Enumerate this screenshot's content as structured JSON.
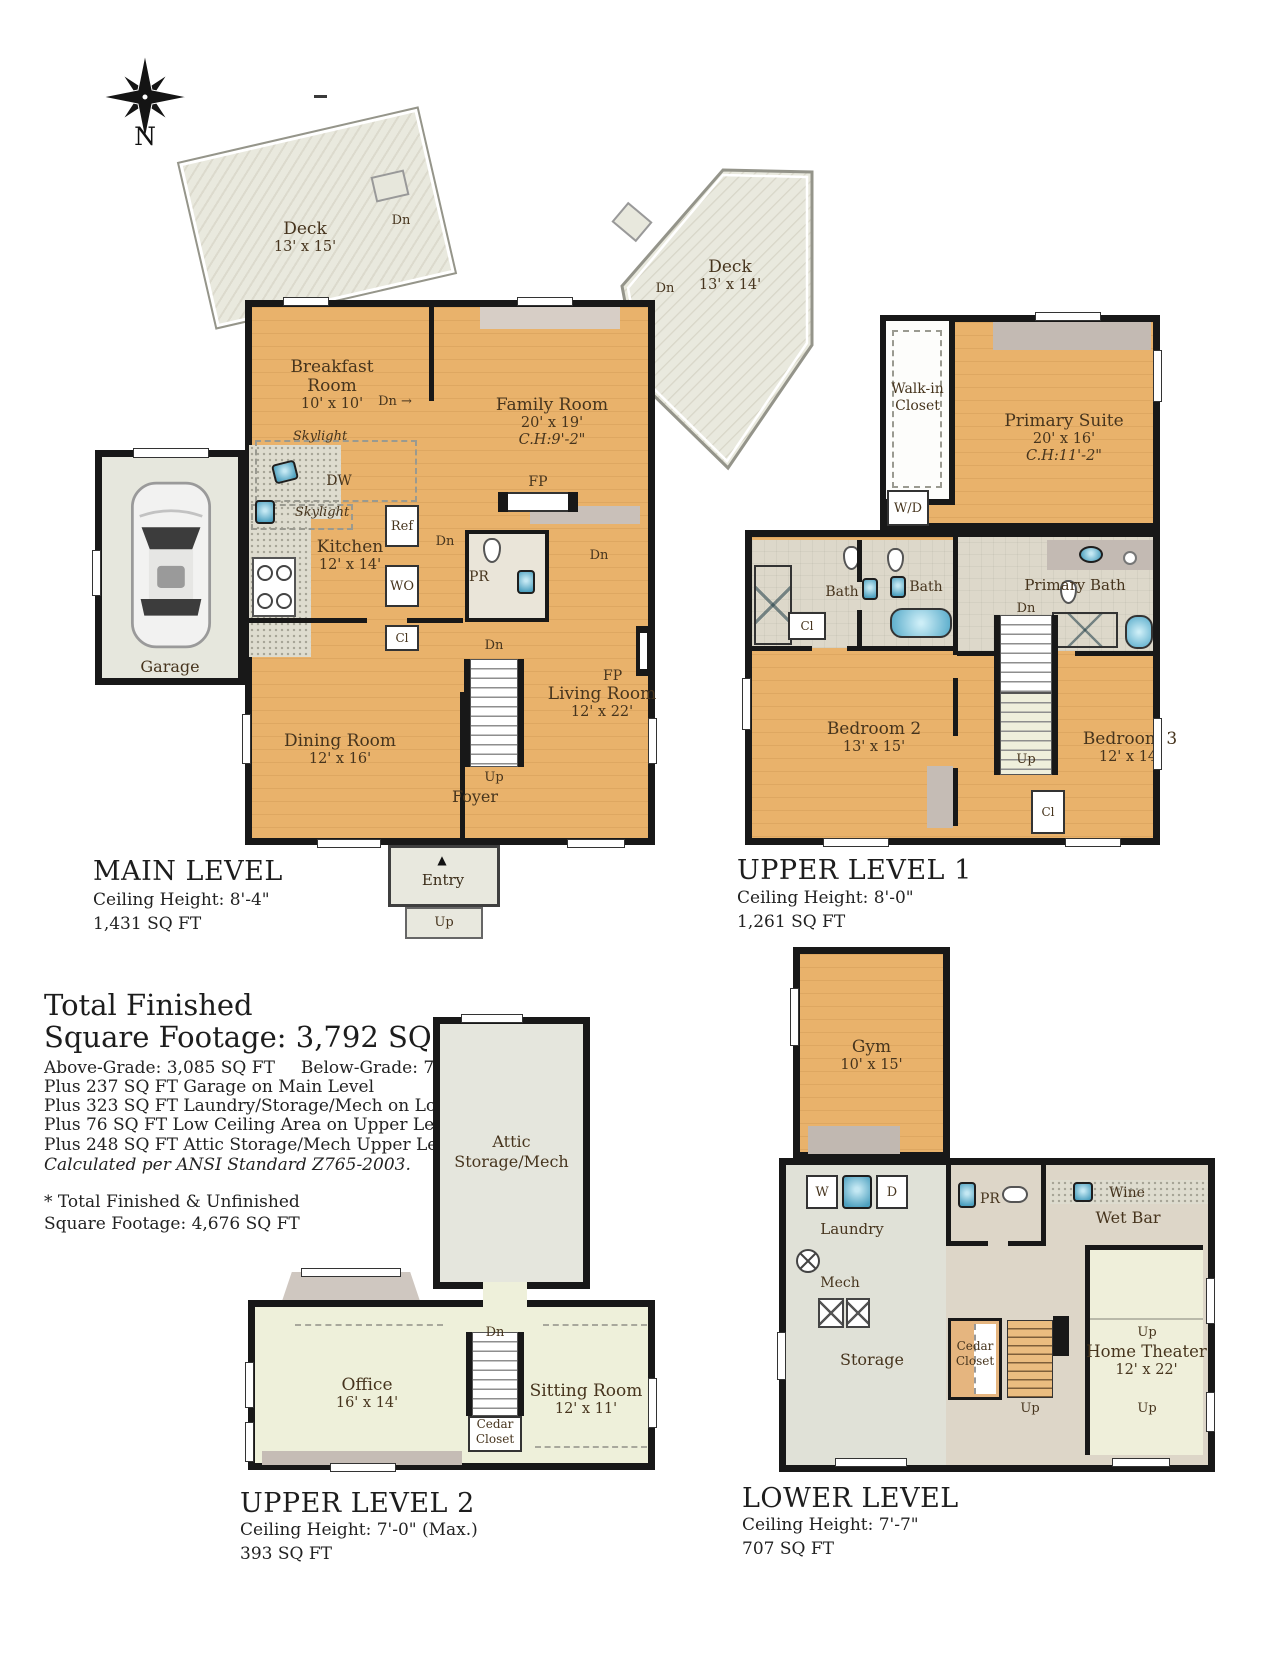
{
  "colors": {
    "wood_floor": "#e9b26b",
    "deck": "#e7e7dc",
    "tile": "#ddd8ca",
    "pale_floor": "#eef0da",
    "gray_room": "#e4e5db",
    "wall": "#181818",
    "fixture_blue": "#5fb3d1",
    "label_brown": "#46341d",
    "furniture_gray": "#c5bcb5"
  },
  "icons": {
    "compass_rose": "8-point star",
    "entry_triangle": "▲",
    "right_arrow": "→"
  },
  "compass": {
    "north": "N"
  },
  "main_level": {
    "title": "MAIN LEVEL",
    "ceiling": "Ceiling Height: 8'-4\"",
    "area": "1,431 SQ FT",
    "deck_left": {
      "name": "Deck",
      "dims": "13' x 15'"
    },
    "deck_right": {
      "name": "Deck",
      "dims": "13' x 14'"
    },
    "rooms": {
      "breakfast": {
        "line1": "Breakfast",
        "line2": "Room",
        "dims": "10' x 10'"
      },
      "family": {
        "name": "Family Room",
        "dims": "20' x 19'",
        "ch": "C.H:9'-2\""
      },
      "kitchen": {
        "name": "Kitchen",
        "dims": "12' x 14'"
      },
      "dining": {
        "name": "Dining Room",
        "dims": "12' x 16'"
      },
      "living": {
        "name": "Living Room",
        "dims": "12' x 22'"
      },
      "garage": "Garage",
      "foyer": "Foyer",
      "entry": "Entry"
    },
    "tags": {
      "skylight": "Skylight",
      "dw": "DW",
      "ref": "Ref",
      "wo": "WO",
      "cl": "Cl",
      "pr": "PR",
      "fp": "FP",
      "dn": "Dn",
      "up": "Up"
    }
  },
  "upper_level_1": {
    "title": "UPPER LEVEL 1",
    "ceiling": "Ceiling Height: 8'-0\"",
    "area": "1,261 SQ FT",
    "rooms": {
      "walkin": {
        "line1": "Walk-in",
        "line2": "Closet"
      },
      "primary": {
        "name": "Primary Suite",
        "dims": "20' x 16'",
        "ch": "C.H:11'-2\""
      },
      "bath": "Bath",
      "primary_bath": "Primary Bath",
      "bedroom2": {
        "name": "Bedroom 2",
        "dims": "13' x 15'"
      },
      "bedroom3": {
        "name": "Bedroom 3",
        "dims": "12' x 14'"
      }
    },
    "tags": {
      "wd": "W/D",
      "cl": "Cl",
      "dn": "Dn",
      "up": "Up"
    }
  },
  "summary": {
    "line1": "Total Finished",
    "line2": "Square Footage: 3,792 SQ FT",
    "above": "Above-Grade: 3,085 SQ FT",
    "below": "Below-Grade: 707 SQ FT",
    "plus": [
      "Plus 237 SQ FT Garage on Main Level",
      "Plus 323 SQ FT Laundry/Storage/Mech on Lower Level",
      "Plus 76 SQ FT Low Ceiling Area on Upper Level 2",
      "Plus 248 SQ FT Attic Storage/Mech Upper Level 2"
    ],
    "ansi": "Calculated per ANSI Standard Z765-2003.",
    "unfinished1": "* Total Finished & Unfinished",
    "unfinished2": "Square Footage: 4,676 SQ FT"
  },
  "upper_level_2": {
    "title": "UPPER LEVEL 2",
    "ceiling": "Ceiling Height: 7'-0\" (Max.)",
    "area": "393 SQ FT",
    "rooms": {
      "attic": {
        "line1": "Attic",
        "line2": "Storage/Mech"
      },
      "office": {
        "name": "Office",
        "dims": "16' x 14'"
      },
      "sitting": {
        "name": "Sitting Room",
        "dims": "12' x 11'"
      },
      "cedar": {
        "line1": "Cedar",
        "line2": "Closet"
      }
    },
    "tags": {
      "dn": "Dn"
    }
  },
  "lower_level": {
    "title": "LOWER LEVEL",
    "ceiling": "Ceiling Height: 7'-7\"",
    "area": "707 SQ FT",
    "rooms": {
      "gym": {
        "name": "Gym",
        "dims": "10' x 15'"
      },
      "laundry": "Laundry",
      "storage": "Storage",
      "mech": "Mech",
      "wine": "Wine",
      "wetbar": "Wet Bar",
      "home_theater": {
        "name": "Home Theater",
        "dims": "12' x 22'"
      },
      "cedar": {
        "line1": "Cedar",
        "line2": "Closet"
      }
    },
    "tags": {
      "w": "W",
      "d": "D",
      "pr": "PR",
      "up": "Up"
    }
  }
}
